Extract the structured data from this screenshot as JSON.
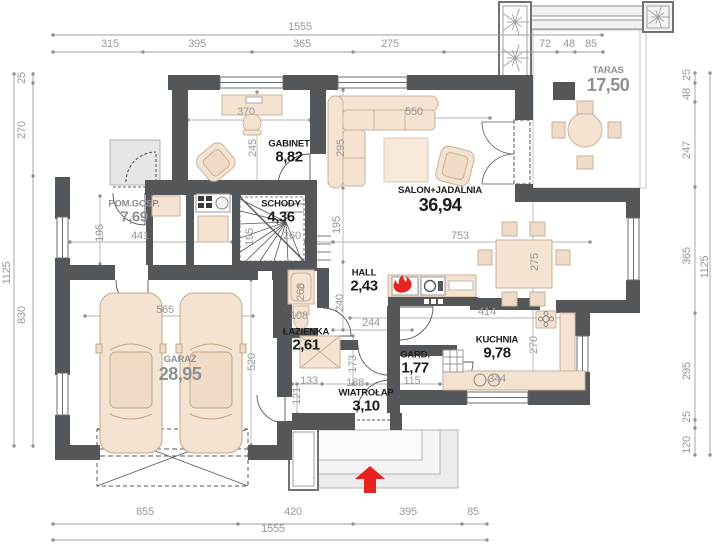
{
  "title": "Ground floor plan",
  "colors": {
    "wall": "#54575a",
    "furniture_fill": "#f4e3d0",
    "furniture_stroke": "#c9b29a",
    "accent_red": "#e6231e",
    "dim_text": "#95989a",
    "room_label": "#1d1d1b",
    "muted_label": "#8d9093"
  },
  "rooms": [
    {
      "name": "POM.GOSP.",
      "area": "7,69",
      "muted": true,
      "big": false,
      "cx": 134,
      "cy": 212
    },
    {
      "name": "GABINET",
      "area": "8,82",
      "muted": false,
      "big": false,
      "cx": 289,
      "cy": 152
    },
    {
      "name": "SCHODY",
      "area": "4,36",
      "muted": false,
      "big": false,
      "cx": 281,
      "cy": 212
    },
    {
      "name": "SALON+JADALNIA",
      "area": "36,94",
      "muted": false,
      "big": true,
      "cx": 440,
      "cy": 200
    },
    {
      "name": "TARAS",
      "area": "17,50",
      "muted": true,
      "big": true,
      "cx": 608,
      "cy": 80
    },
    {
      "name": "HALL",
      "area": "2,43",
      "muted": false,
      "big": false,
      "cx": 364,
      "cy": 281
    },
    {
      "name": "ŁAZIENKA",
      "area": "2,61",
      "muted": false,
      "big": false,
      "cx": 306,
      "cy": 340
    },
    {
      "name": "GARD.",
      "area": "1,77",
      "muted": false,
      "big": false,
      "cx": 415,
      "cy": 363
    },
    {
      "name": "KUCHNIA",
      "area": "9,78",
      "muted": false,
      "big": false,
      "cx": 497,
      "cy": 348
    },
    {
      "name": "WIATROŁAP",
      "area": "3,10",
      "muted": false,
      "big": false,
      "cx": 366,
      "cy": 401
    },
    {
      "name": "GARAŻ",
      "area": "28,95",
      "muted": true,
      "big": true,
      "cx": 180,
      "cy": 369
    }
  ],
  "dim_labels": [
    {
      "t": "1555",
      "x": 300,
      "y": 27
    },
    {
      "t": "315",
      "x": 110,
      "y": 44
    },
    {
      "t": "395",
      "x": 197,
      "y": 44
    },
    {
      "t": "365",
      "x": 302,
      "y": 44
    },
    {
      "t": "275",
      "x": 390,
      "y": 44
    },
    {
      "t": "72",
      "x": 545,
      "y": 44
    },
    {
      "t": "48",
      "x": 569,
      "y": 44
    },
    {
      "t": "85",
      "x": 591,
      "y": 44
    },
    {
      "t": "655",
      "x": 145,
      "y": 512
    },
    {
      "t": "420",
      "x": 293,
      "y": 512
    },
    {
      "t": "395",
      "x": 408,
      "y": 512
    },
    {
      "t": "85",
      "x": 473,
      "y": 512
    },
    {
      "t": "1555",
      "x": 273,
      "y": 529
    },
    {
      "t": "25",
      "x": 22,
      "y": 78,
      "v": 1
    },
    {
      "t": "270",
      "x": 22,
      "y": 130,
      "v": 1
    },
    {
      "t": "830",
      "x": 22,
      "y": 315,
      "v": 1
    },
    {
      "t": "1125",
      "x": 7,
      "y": 273,
      "v": 1
    },
    {
      "t": "25",
      "x": 687,
      "y": 75,
      "v": 1
    },
    {
      "t": "48",
      "x": 687,
      "y": 94,
      "v": 1
    },
    {
      "t": "247",
      "x": 687,
      "y": 150,
      "v": 1
    },
    {
      "t": "365",
      "x": 687,
      "y": 256,
      "v": 1
    },
    {
      "t": "295",
      "x": 687,
      "y": 371,
      "v": 1
    },
    {
      "t": "25",
      "x": 687,
      "y": 417,
      "v": 1
    },
    {
      "t": "120",
      "x": 687,
      "y": 445,
      "v": 1
    },
    {
      "t": "1125",
      "x": 705,
      "y": 267,
      "v": 1
    },
    {
      "t": "370",
      "x": 246,
      "y": 112
    },
    {
      "t": "245",
      "x": 253,
      "y": 148,
      "v": 1
    },
    {
      "t": "295",
      "x": 341,
      "y": 148,
      "v": 1
    },
    {
      "t": "550",
      "x": 414,
      "y": 112
    },
    {
      "t": "753",
      "x": 460,
      "y": 236
    },
    {
      "t": "195",
      "x": 100,
      "y": 233,
      "v": 1
    },
    {
      "t": "441",
      "x": 140,
      "y": 236
    },
    {
      "t": "195",
      "x": 250,
      "y": 237,
      "v": 1
    },
    {
      "t": "260",
      "x": 292,
      "y": 236
    },
    {
      "t": "195",
      "x": 337,
      "y": 225,
      "v": 1
    },
    {
      "t": "268",
      "x": 301,
      "y": 292,
      "v": 1
    },
    {
      "t": "240",
      "x": 340,
      "y": 303,
      "v": 1
    },
    {
      "t": "108",
      "x": 299,
      "y": 316
    },
    {
      "t": "244",
      "x": 371,
      "y": 323
    },
    {
      "t": "414",
      "x": 487,
      "y": 312
    },
    {
      "t": "270",
      "x": 534,
      "y": 345,
      "v": 1
    },
    {
      "t": "344",
      "x": 497,
      "y": 379
    },
    {
      "t": "133",
      "x": 309,
      "y": 381
    },
    {
      "t": "188",
      "x": 355,
      "y": 383
    },
    {
      "t": "173",
      "x": 353,
      "y": 364,
      "v": 1
    },
    {
      "t": "121",
      "x": 297,
      "y": 396,
      "v": 1
    },
    {
      "t": "115",
      "x": 412,
      "y": 381
    },
    {
      "t": "565",
      "x": 165,
      "y": 310
    },
    {
      "t": "520",
      "x": 252,
      "y": 362,
      "v": 1
    },
    {
      "t": "275",
      "x": 535,
      "y": 262,
      "v": 1
    }
  ]
}
